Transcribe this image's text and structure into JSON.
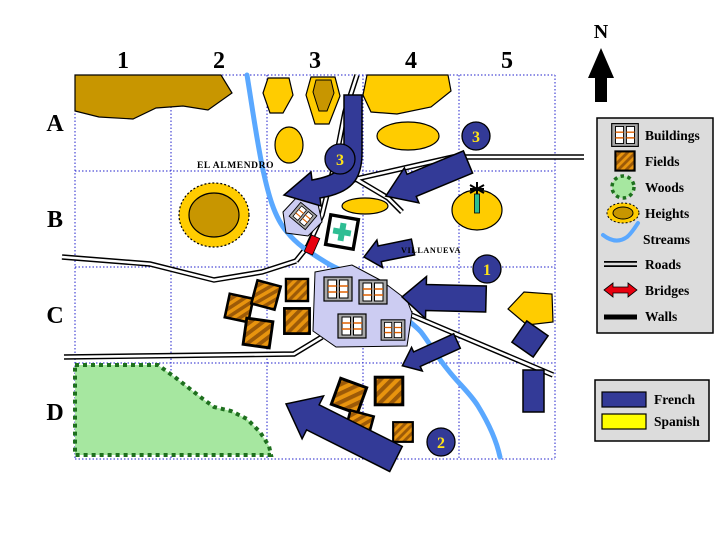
{
  "map": {
    "grid": {
      "columns": [
        "1",
        "2",
        "3",
        "4",
        "5"
      ],
      "rows": [
        "A",
        "B",
        "C",
        "D"
      ]
    },
    "compass": {
      "label": "N"
    },
    "places": [
      {
        "name": "EL ALMENDRO"
      },
      {
        "name": "VILLANUEVA"
      }
    ],
    "markers": [
      {
        "label": "3",
        "location": "bent-arrow-el-almendro"
      },
      {
        "label": "3",
        "location": "top-right-road"
      },
      {
        "label": "1",
        "location": "east-of-villanueva"
      },
      {
        "label": "2",
        "location": "south-bottom"
      }
    ]
  },
  "legend": {
    "items": [
      {
        "label": "Buildings",
        "icon": "buildings-icon"
      },
      {
        "label": "Fields",
        "icon": "fields-icon"
      },
      {
        "label": "Woods",
        "icon": "woods-icon"
      },
      {
        "label": "Heights",
        "icon": "heights-icon"
      },
      {
        "label": "Streams",
        "icon": "streams-icon"
      },
      {
        "label": "Roads",
        "icon": "roads-icon"
      },
      {
        "label": "Bridges",
        "icon": "bridges-icon"
      },
      {
        "label": "Walls",
        "icon": "walls-icon"
      }
    ]
  },
  "forces": {
    "items": [
      {
        "label": "French",
        "color": "#333A97"
      },
      {
        "label": "Spanish",
        "color": "#FFFF00"
      }
    ]
  },
  "colors": {
    "french": "#333A97",
    "spanish_swatch": "#FFFF00",
    "map_yellow": "#FFCC00",
    "heights_core": "#C89600",
    "stream": "#5AA8FF",
    "woods_fill": "#A6E7A0",
    "woods_edge": "#1E701E",
    "field_base": "#E8940E",
    "field_stripe": "#9C5A08",
    "bridge_red": "#E8000F",
    "village_fill": "#CCCCF2",
    "grid_blue": "#2222CC",
    "cross_teal": "#2EBD93",
    "legend_bg": "#DCDCDC"
  }
}
